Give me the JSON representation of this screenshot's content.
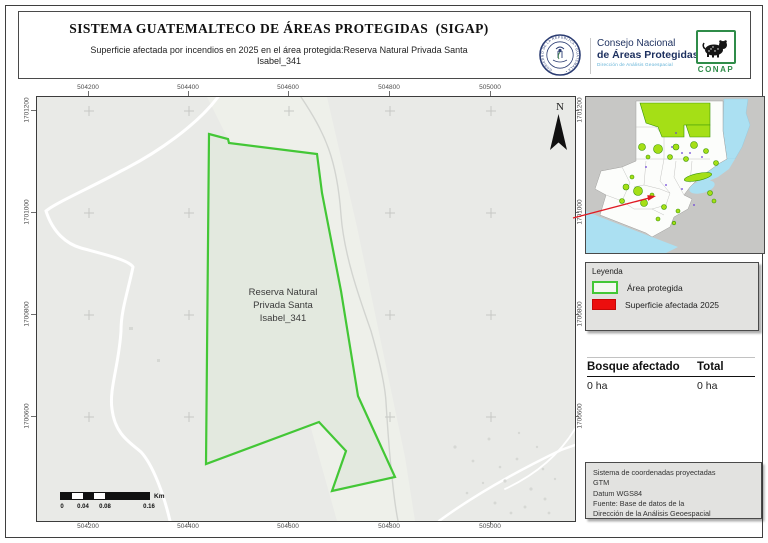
{
  "header": {
    "title": "SISTEMA GUATEMALTECO DE ÁREAS PROTEGIDAS  (SIGAP)",
    "subtitle_line1": "Superficie afectada por incendios en 2025 en el área protegida:Reserva Natural Privada Santa",
    "subtitle_line2": "Isabel_341",
    "logos": {
      "seal_text": "GOBIERNO DE LA REPÚBLICA • GUATEMALA •",
      "conap_line1": "Consejo Nacional",
      "conap_line2": "de Áreas Protegidas",
      "conap_line3": "Dirección de Análisis Geoespacial",
      "conap_badge": "CONAP"
    }
  },
  "map": {
    "x_ticks": [
      "504200",
      "504400",
      "504600",
      "504800",
      "505000"
    ],
    "y_ticks": [
      "1701200",
      "1701000",
      "1700800",
      "1700600"
    ],
    "polygon_label_line1": "Reserva Natural",
    "polygon_label_line2": "Privada Santa",
    "polygon_label_line3": "Isabel_341",
    "north_label": "N",
    "scale_bar": {
      "labels": [
        "0",
        "0.04",
        "0.08",
        "0.16"
      ],
      "unit": "Km"
    }
  },
  "legend": {
    "title": "Leyenda",
    "items": [
      {
        "label": "Área protegida"
      },
      {
        "label": "Superficie afectada 2025"
      }
    ]
  },
  "stats": {
    "col1_header": "Bosque afectado",
    "col2_header": "Total",
    "col1_value": "0 ha",
    "col2_value": "0 ha"
  },
  "credits": {
    "line1": "Sistema de coordenadas proyectadas",
    "line2": "GTM",
    "line3": "Datum WGS84",
    "line4": "Fuente: Base de datos de la",
    "line5": "Dirección de la Análisis Geoespacial"
  },
  "colors": {
    "protected_green": "#43c736",
    "affected_red": "#ec0e0e",
    "inset_green": "#a5df16",
    "water_blue": "#abe0f2",
    "surrounding_gray": "#c7c7c5",
    "callout_red": "#e01b24"
  }
}
